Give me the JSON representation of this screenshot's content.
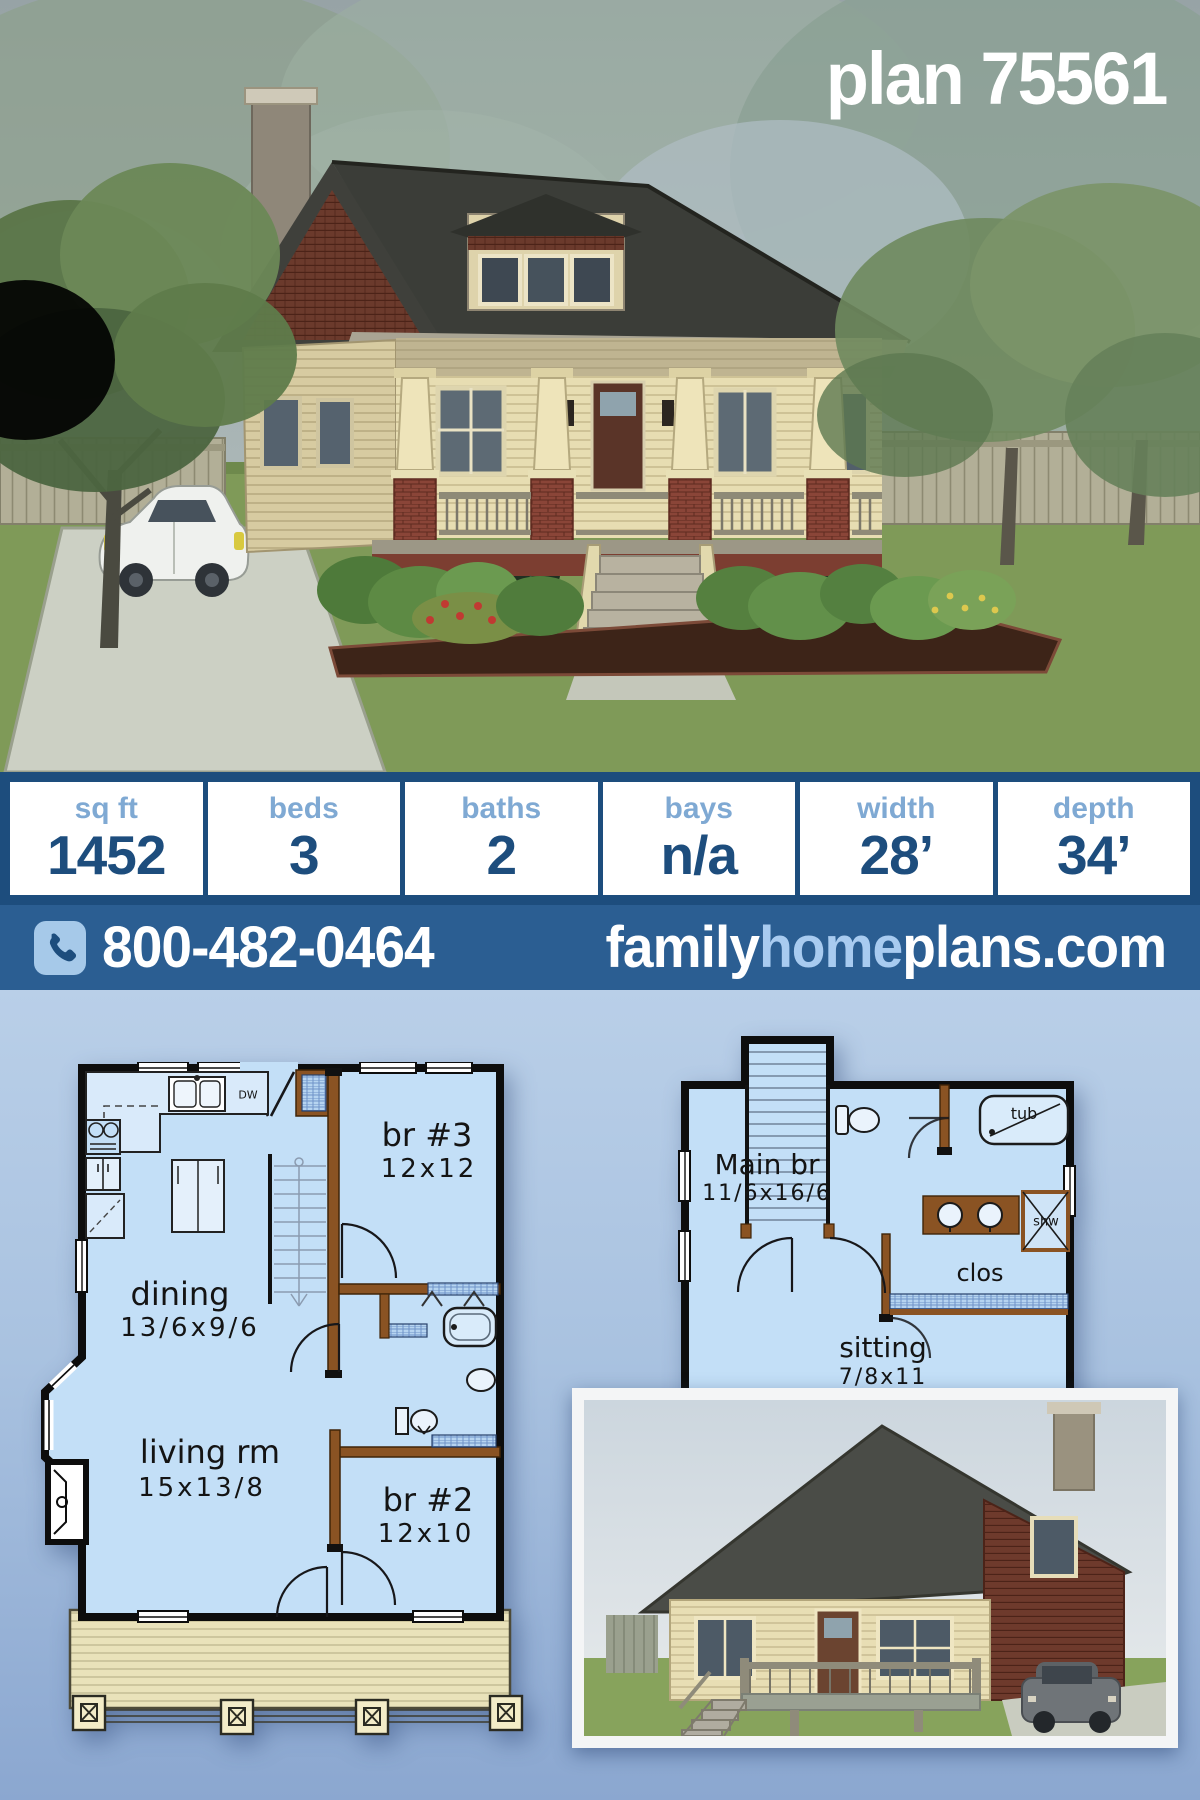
{
  "header": {
    "title": "plan 75561"
  },
  "stats": {
    "columns": [
      {
        "label": "sq ft",
        "value": "1452"
      },
      {
        "label": "beds",
        "value": "3"
      },
      {
        "label": "baths",
        "value": "2"
      },
      {
        "label": "bays",
        "value": "n/a"
      },
      {
        "label": "width",
        "value": "28’"
      },
      {
        "label": "depth",
        "value": "34’"
      }
    ]
  },
  "contact": {
    "phone": "800-482-0464",
    "phone_icon": "phone-icon",
    "site_family": "family",
    "site_home": "home",
    "site_plans": "plans.com"
  },
  "floorplans": {
    "first": {
      "rooms": [
        {
          "name": "br #3",
          "dims": "12x12"
        },
        {
          "name": "dining",
          "dims": "13/6x9/6"
        },
        {
          "name": "living rm",
          "dims": "15x13/8"
        },
        {
          "name": "br #2",
          "dims": "12x10"
        }
      ],
      "kitchen_dw": "DW"
    },
    "second": {
      "rooms": [
        {
          "name": "Main br",
          "dims": "11/6x16/6"
        },
        {
          "name": "sitting",
          "dims": "7/8x11"
        }
      ],
      "labels": {
        "tub": "tub",
        "shw": "shw",
        "clos": "clos"
      }
    }
  },
  "colors": {
    "dark_blue": "#1d4d7d",
    "bar_blue": "#2b5e92",
    "light_blue_label": "#7fa9d3",
    "chip_blue": "#a6c9e9",
    "plan_floor": "#c3dff7",
    "plan_wall_brown": "#8a5323",
    "porch_tan": "#e9e2ba",
    "bg_top": "#b9cfe8",
    "bg_bottom": "#8ba7d0"
  }
}
